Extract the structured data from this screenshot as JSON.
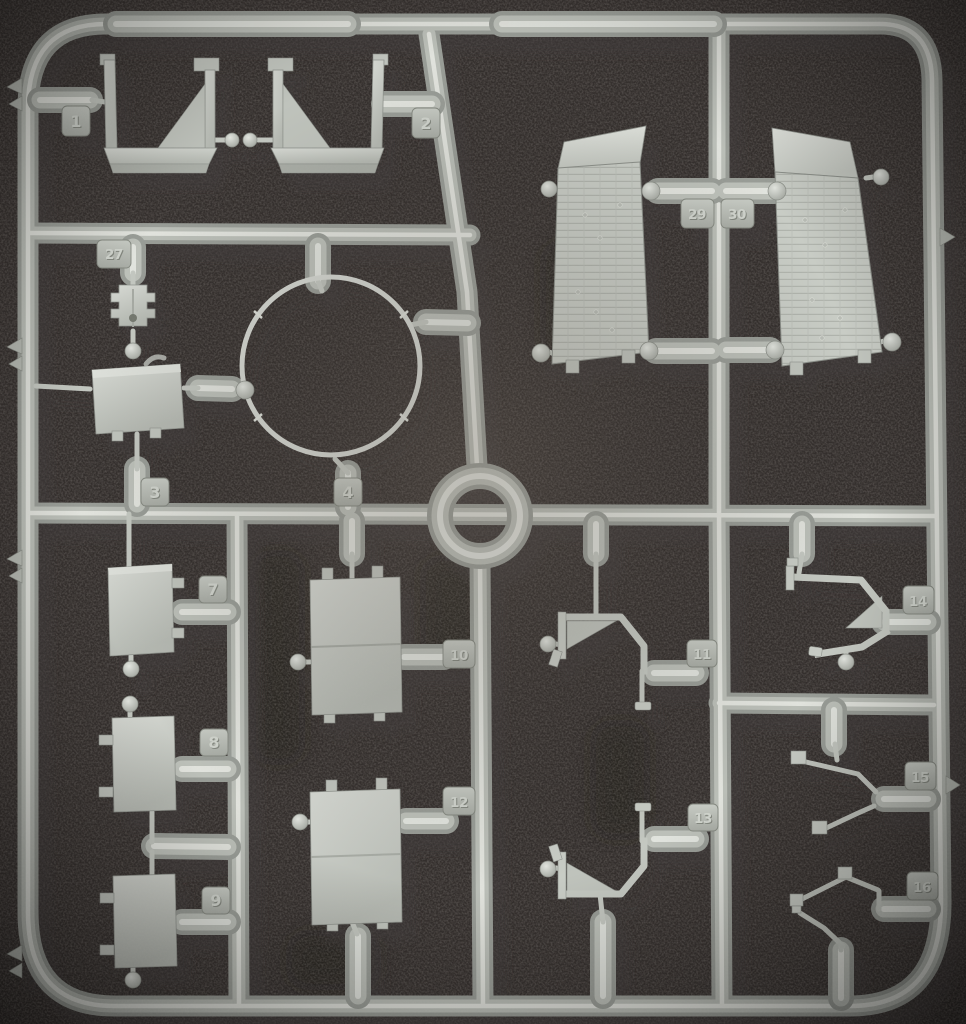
{
  "scene": {
    "subject": "gray injection-molded plastic model kit sprue lying on dark foam",
    "colors": {
      "foam": "#332e2c",
      "foam_highlight": "#4a443f",
      "plastic_base": "#9a9e98",
      "plastic_mid": "#bbbfb8",
      "plastic_highlight": "#e8eae4",
      "part_face": "#c9ccc6",
      "tag_face": "#b2b6b0",
      "ring_part": "#d4d7d1"
    }
  },
  "sprue": {
    "part_tags": [
      {
        "number": "1"
      },
      {
        "number": "2"
      },
      {
        "number": "27"
      },
      {
        "number": "3"
      },
      {
        "number": "4"
      },
      {
        "number": "29"
      },
      {
        "number": "30"
      },
      {
        "number": "7"
      },
      {
        "number": "8"
      },
      {
        "number": "9"
      },
      {
        "number": "10"
      },
      {
        "number": "12"
      },
      {
        "number": "11"
      },
      {
        "number": "13"
      },
      {
        "number": "14"
      },
      {
        "number": "15"
      },
      {
        "number": "16"
      }
    ]
  }
}
